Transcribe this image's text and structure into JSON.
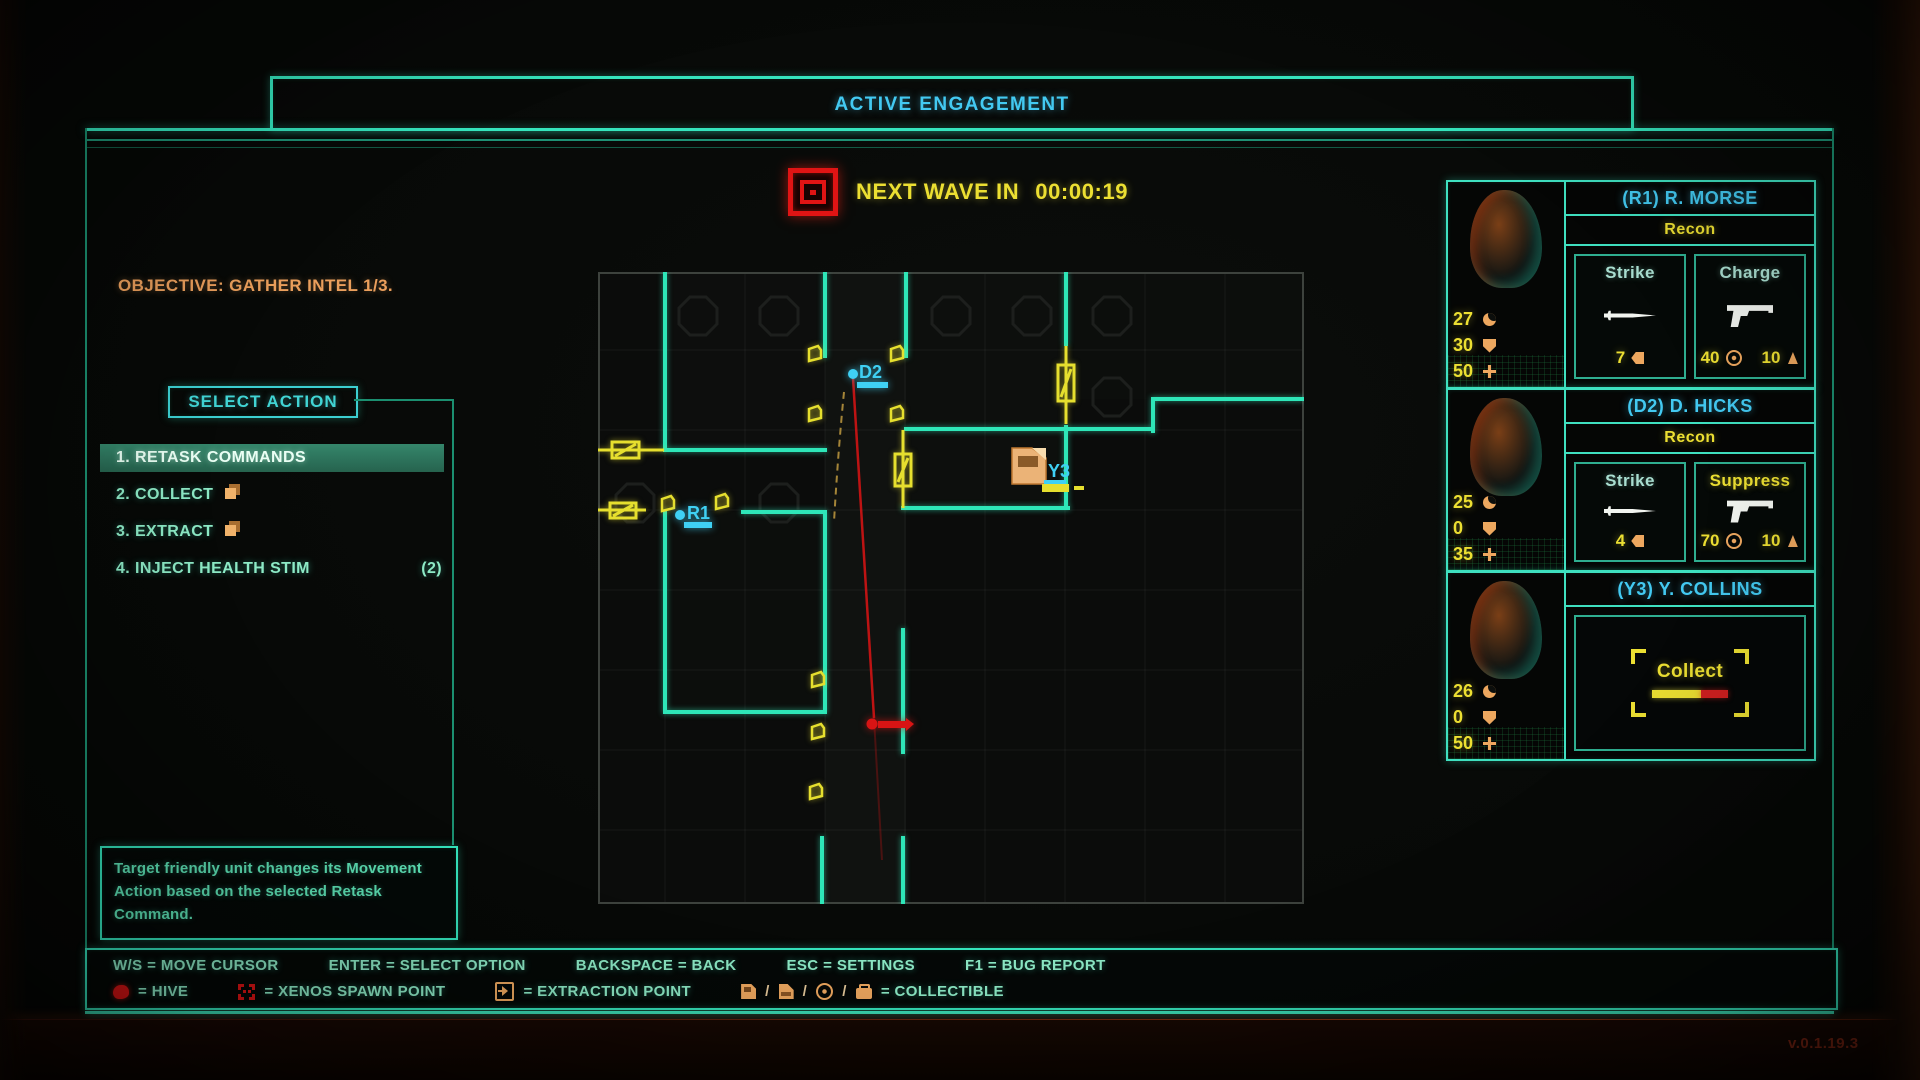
{
  "header": {
    "title": "ACTIVE ENGAGEMENT"
  },
  "wave": {
    "label": "NEXT WAVE IN",
    "time": "00:00:19"
  },
  "objective": "OBJECTIVE: GATHER INTEL 1/3.",
  "action_menu": {
    "title": "SELECT ACTION",
    "items": [
      {
        "label": "1. RETASK COMMANDS",
        "selected": true
      },
      {
        "label": "2. COLLECT",
        "icon": "pages-icon"
      },
      {
        "label": "3. EXTRACT",
        "icon": "pages-icon"
      },
      {
        "label": "4. INJECT HEALTH STIM",
        "count": "(2)"
      }
    ],
    "tooltip": "Target friendly unit changes its Movement Action based on the selected Retask Command."
  },
  "map": {
    "units": [
      {
        "id": "D2"
      },
      {
        "id": "R1"
      },
      {
        "id": "Y3"
      }
    ]
  },
  "squad": [
    {
      "name": "(R1) R. MORSE",
      "class": "Recon",
      "stats": [
        {
          "value": "27",
          "icon": "move-icon"
        },
        {
          "value": "30",
          "icon": "armor-icon"
        },
        {
          "value": "50",
          "icon": "health-icon"
        }
      ],
      "abilities": [
        {
          "title": "Strike",
          "icon": "knife-icon",
          "cost": "7"
        },
        {
          "title": "Charge",
          "icon": "pistol-icon",
          "accuracy": "40",
          "radius": "10"
        }
      ]
    },
    {
      "name": "(D2) D. HICKS",
      "class": "Recon",
      "stats": [
        {
          "value": "25",
          "icon": "move-icon"
        },
        {
          "value": "0",
          "icon": "armor-icon"
        },
        {
          "value": "35",
          "icon": "health-icon"
        }
      ],
      "abilities": [
        {
          "title": "Strike",
          "icon": "knife-icon",
          "cost": "4"
        },
        {
          "title": "Suppress",
          "icon": "pistol-icon",
          "accuracy": "70",
          "radius": "10",
          "highlight": true
        }
      ]
    },
    {
      "name": "(Y3) Y. COLLINS",
      "stats": [
        {
          "value": "26",
          "icon": "move-icon"
        },
        {
          "value": "0",
          "icon": "armor-icon"
        },
        {
          "value": "50",
          "icon": "health-icon"
        }
      ],
      "action": {
        "label": "Collect",
        "progress": "64"
      }
    }
  ],
  "legend": {
    "sep": "/",
    "controls": [
      "W/S = MOVE CURSOR",
      "ENTER = SELECT OPTION",
      "BACKSPACE = BACK",
      "ESC = SETTINGS",
      "F1 = BUG REPORT"
    ],
    "symbols": [
      {
        "icon": "hive-icon",
        "text": "= HIVE"
      },
      {
        "icon": "xenos-spawn-icon",
        "text": "= XENOS SPAWN POINT"
      },
      {
        "icon": "extraction-point-icon",
        "text": "= EXTRACTION POINT"
      },
      {
        "icons": [
          "disk-icon",
          "document-icon",
          "disc-icon",
          "case-icon"
        ],
        "text": "= COLLECTIBLE"
      }
    ]
  },
  "version": "v.0.1.19.3"
}
